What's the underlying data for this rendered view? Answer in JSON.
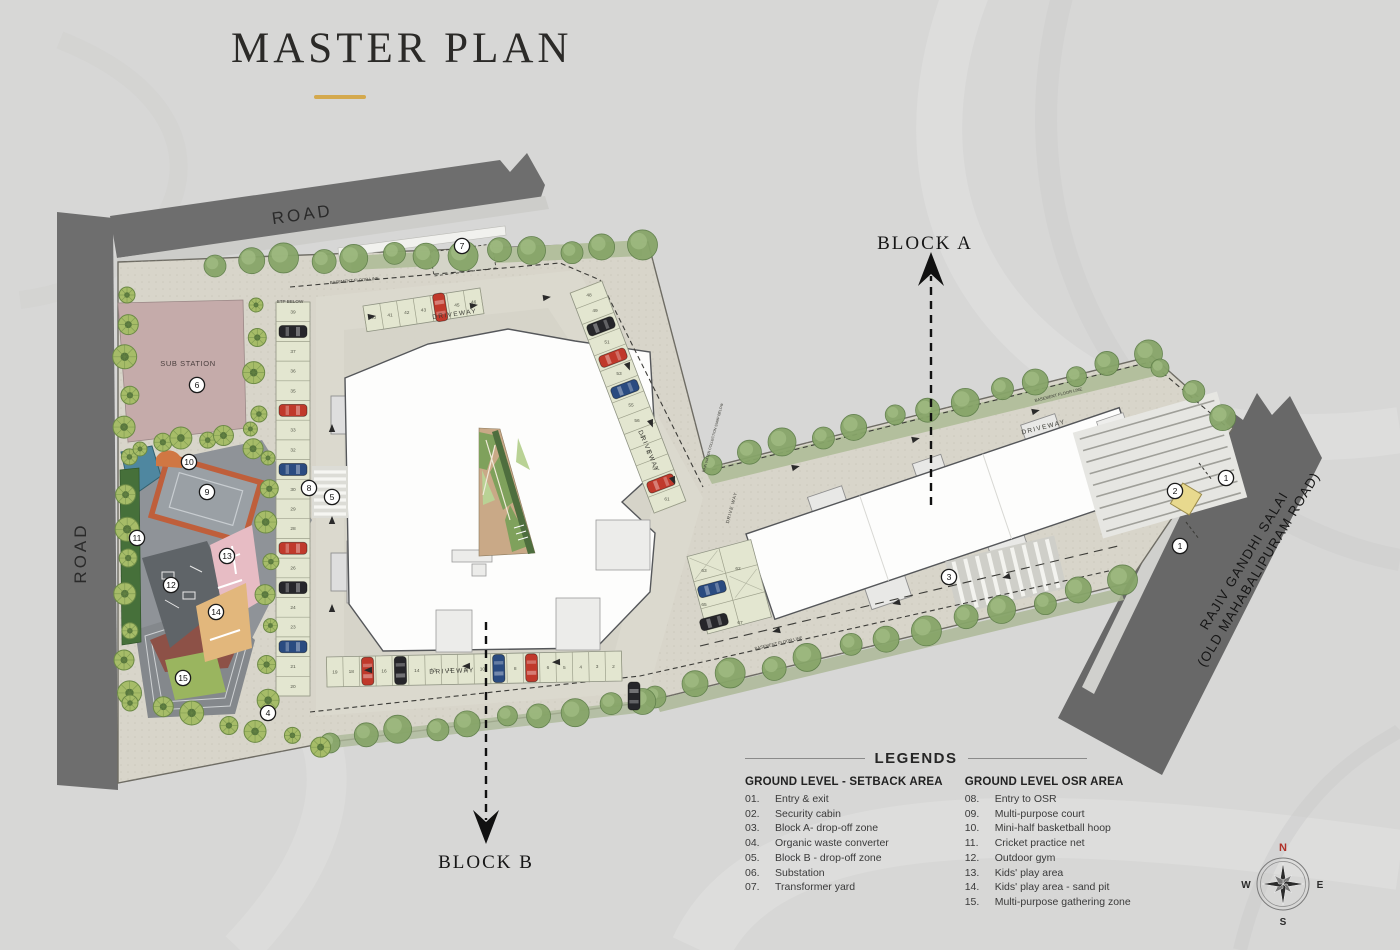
{
  "title": {
    "text": "MASTER PLAN"
  },
  "blocks": {
    "a": "BLOCK A",
    "b": "BLOCK B"
  },
  "roads": {
    "top": "ROAD",
    "left": "ROAD",
    "right_line1": "RAJIV GANDHI SALAI",
    "right_line2": "(OLD MAHABALIPURAM ROAD)"
  },
  "site_labels": {
    "sub_station": "SUB STATION",
    "stp_below": "STP BELOW",
    "driveway": "DRIVEWAY",
    "drive_way": "DRIVE WAY",
    "basement_floor_line": "BASEMENT FLOOR LINE",
    "rain_water": "RAIN WATER COLLECTION SUMP BELOW"
  },
  "legends": {
    "title": "LEGENDS",
    "columns": [
      {
        "header": "GROUND LEVEL - SETBACK AREA",
        "items": [
          {
            "num": "01.",
            "label": "Entry & exit"
          },
          {
            "num": "02.",
            "label": "Security cabin"
          },
          {
            "num": "03.",
            "label": "Block A- drop-off zone"
          },
          {
            "num": "04.",
            "label": "Organic waste converter"
          },
          {
            "num": "05.",
            "label": "Block B - drop-off zone"
          },
          {
            "num": "06.",
            "label": "Substation"
          },
          {
            "num": "07.",
            "label": "Transformer yard"
          }
        ]
      },
      {
        "header": "GROUND LEVEL OSR AREA",
        "items": [
          {
            "num": "08.",
            "label": "Entry to OSR"
          },
          {
            "num": "09.",
            "label": "Multi-purpose court"
          },
          {
            "num": "10.",
            "label": "Mini-half basketball hoop"
          },
          {
            "num": "11.",
            "label": "Cricket practice net"
          },
          {
            "num": "12.",
            "label": "Outdoor gym"
          },
          {
            "num": "13.",
            "label": "Kids' play area"
          },
          {
            "num": "14.",
            "label": "Kids' play area - sand pit"
          },
          {
            "num": "15.",
            "label": "Multi-purpose gathering zone"
          }
        ]
      }
    ]
  },
  "compass": {
    "n": "N",
    "e": "E",
    "s": "S",
    "w": "W"
  },
  "plan_markers": [
    {
      "num": "1",
      "x": 1226,
      "y": 478
    },
    {
      "num": "1",
      "x": 1180,
      "y": 546
    },
    {
      "num": "2",
      "x": 1175,
      "y": 491
    },
    {
      "num": "3",
      "x": 949,
      "y": 577
    },
    {
      "num": "4",
      "x": 268,
      "y": 713
    },
    {
      "num": "5",
      "x": 332,
      "y": 497
    },
    {
      "num": "6",
      "x": 197,
      "y": 385
    },
    {
      "num": "7",
      "x": 462,
      "y": 246
    },
    {
      "num": "8",
      "x": 309,
      "y": 488
    },
    {
      "num": "9",
      "x": 207,
      "y": 492
    },
    {
      "num": "10",
      "x": 189,
      "y": 462
    },
    {
      "num": "11",
      "x": 137,
      "y": 538
    },
    {
      "num": "12",
      "x": 171,
      "y": 585
    },
    {
      "num": "13",
      "x": 227,
      "y": 556
    },
    {
      "num": "14",
      "x": 216,
      "y": 612
    },
    {
      "num": "15",
      "x": 183,
      "y": 678
    }
  ],
  "parking": {
    "left_column": [
      "39",
      "38",
      "37",
      "36",
      "35",
      "34",
      "33",
      "32",
      "31",
      "30",
      "29",
      "28",
      "27",
      "26",
      "25",
      "24",
      "23",
      "22",
      "21",
      "20"
    ],
    "top_row": [
      "40",
      "41",
      "42",
      "43",
      "44",
      "45",
      "46"
    ],
    "diagonal": [
      "48",
      "49",
      "50",
      "51",
      "52",
      "53",
      "54",
      "55",
      "56",
      "57",
      "58",
      "59",
      "60",
      "61"
    ],
    "bottom_row": [
      "19",
      "18",
      "17",
      "16",
      "15",
      "14",
      "13",
      "12",
      "11",
      "10",
      "9",
      "8",
      "7",
      "6",
      "5",
      "4",
      "3",
      "2"
    ],
    "block_a": [
      "63",
      "62",
      "65",
      "67"
    ]
  },
  "colors": {
    "accent_gold": "#d4a94e",
    "road": "#6e6e6e",
    "site": "#d8d5ca",
    "stall": "#e3e6d0",
    "tree": "#87a569",
    "palm": "#a6bc68",
    "court_orange": "#bf5f3b",
    "pool": "#4f87a0",
    "substation": "#c5abaa",
    "sand": "#e2b77c",
    "play_pink": "#e7bcc4",
    "gathering": "#8d5147",
    "lawn": "#9ab55f",
    "gym": "#5f6468",
    "car_red": "#c0392b",
    "car_blue": "#2a4b80",
    "car_black": "#26262a",
    "building": "#fdfdfc"
  }
}
